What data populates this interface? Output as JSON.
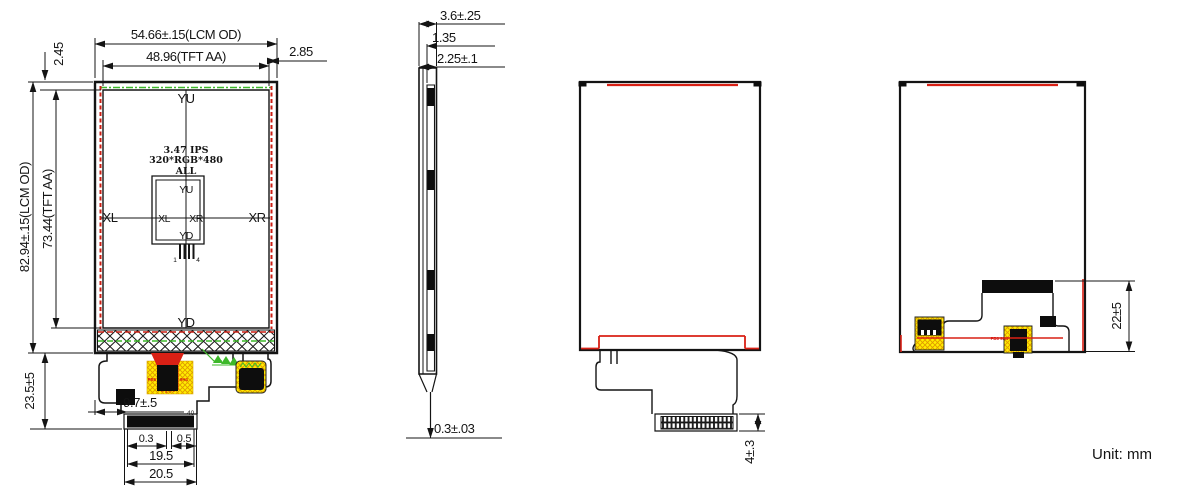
{
  "unit_label": "Unit: mm",
  "views": {
    "front": {
      "dims": {
        "lcm_width": "54.66±.15(LCM OD)",
        "aa_width": "48.96(TFT AA)",
        "top_margin": "2.45",
        "right_margin": "2.85",
        "lcm_height": "82.94±.15(LCM OD)",
        "aa_height": "73.44(TFT AA)",
        "fpc_length": "23.5±5",
        "fpc_offset": "9.7±.5",
        "pin_count": "40",
        "contact_margin_left": "0.3",
        "contact_margin_right": "0.5",
        "contact_width": "19.5",
        "tail_width": "20.5"
      },
      "labels": {
        "size_type": "3.47 IPS",
        "resolution": "320*RGB*480",
        "all": "ALL",
        "yu": "YU",
        "yd": "YD",
        "xl": "XL",
        "xr": "XR",
        "inner_yu": "YU",
        "inner_yd": "YD",
        "inner_xl": "XL",
        "inner_xr": "XR",
        "pin_first": "1",
        "pin_last": "4",
        "ic_marking_left": "PB6",
        "ic_marking_right": "9H4"
      }
    },
    "side": {
      "dims": {
        "total_thickness": "3.6±.25",
        "tp_thickness": "1.35",
        "lcm_thickness": "2.25±.1",
        "fpc_thickness": "0.3±.03"
      }
    },
    "back_open": {
      "dims": {
        "connector_length": "4±.3"
      }
    },
    "back_folded": {
      "dims": {
        "fold_height": "22±5"
      },
      "labels": {
        "ic_marking": "PB6 9H4"
      }
    }
  },
  "colors": {
    "outline": "#141414",
    "red": "#d92015",
    "green": "#3db82a",
    "yellow": "#ffee00",
    "hatch_orange": "#e09a00"
  }
}
